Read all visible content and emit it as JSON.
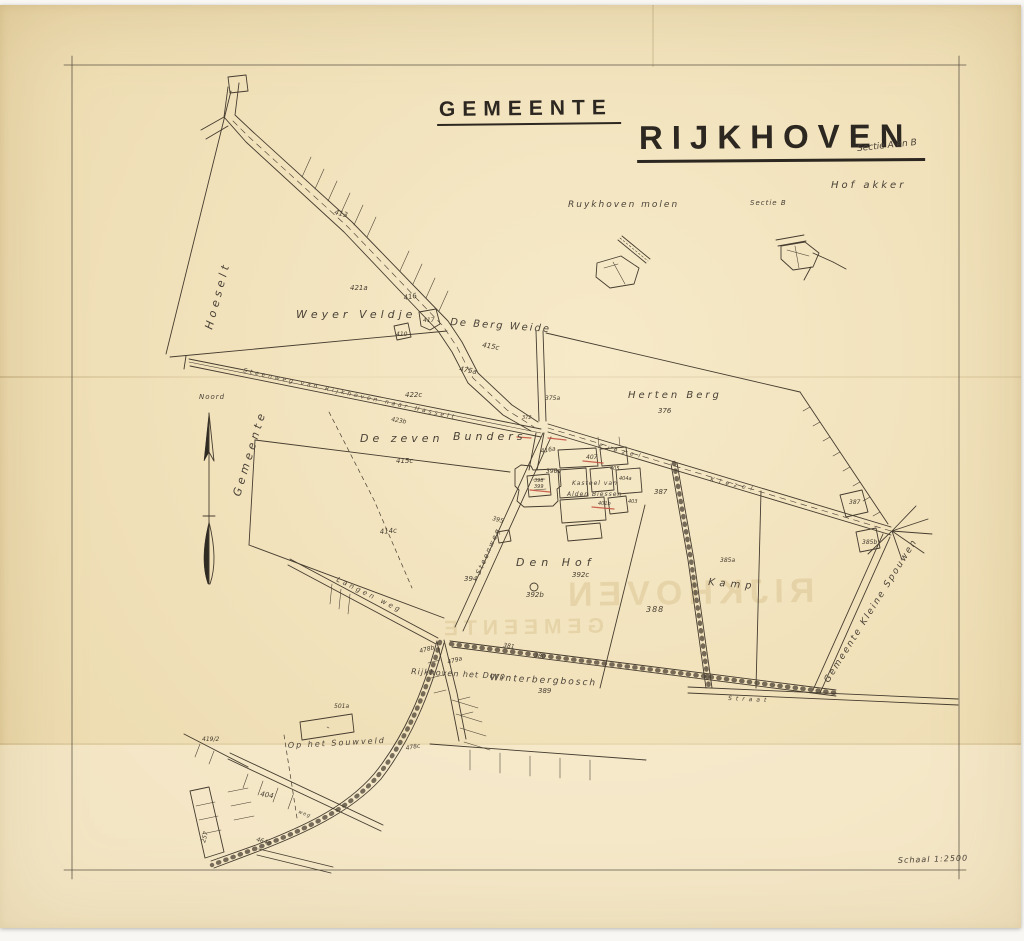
{
  "title": {
    "line1": "GEMEENTE",
    "line2": "RIJKHOVEN",
    "sectie": "Sectie A en B"
  },
  "ghost": {
    "line1": "GEMEENTE",
    "line2": "RIJKHOVEN"
  },
  "colors": {
    "paper": "#f4e4ba",
    "ink": "#453c2f",
    "red_annotation": "#c24b3c",
    "frame": "#5d5546",
    "ghost": "#c9ae74"
  },
  "map": {
    "labels": [
      {
        "id": "hoeselt",
        "text": "Hoeselt",
        "x": 212,
        "y": 330,
        "size": 11,
        "rot": -75,
        "ls": 4,
        "cls": "script"
      },
      {
        "id": "gemeente-boundary",
        "text": "Gemeente",
        "x": 240,
        "y": 497,
        "size": 11,
        "rot": -73,
        "ls": 4,
        "cls": "script"
      },
      {
        "id": "noord",
        "text": "Noord",
        "x": 199,
        "y": 399,
        "size": 7,
        "rot": 0,
        "ls": 1,
        "cls": "script"
      },
      {
        "id": "weyer-veldje",
        "text": "Weyer Veldje",
        "x": 296,
        "y": 318,
        "size": 11,
        "rot": 0,
        "ls": 4,
        "cls": "script"
      },
      {
        "id": "p421a",
        "text": "421a",
        "x": 350,
        "y": 290,
        "size": 7,
        "rot": 0,
        "ls": 0,
        "cls": "num"
      },
      {
        "id": "p413",
        "text": "413",
        "x": 334,
        "y": 214,
        "size": 7,
        "rot": 15,
        "ls": 0,
        "cls": "num"
      },
      {
        "id": "p416",
        "text": "416",
        "x": 404,
        "y": 300,
        "size": 7,
        "rot": -10,
        "ls": 0,
        "cls": "num"
      },
      {
        "id": "p417",
        "text": "417",
        "x": 423,
        "y": 322,
        "size": 6,
        "rot": 0,
        "ls": 0,
        "cls": "num"
      },
      {
        "id": "p410",
        "text": "410",
        "x": 396,
        "y": 336,
        "size": 6,
        "rot": 0,
        "ls": 0,
        "cls": "num"
      },
      {
        "id": "de-berg-weide",
        "text": "De Berg Weide",
        "x": 450,
        "y": 325,
        "size": 10,
        "rot": 4,
        "ls": 2,
        "cls": "script"
      },
      {
        "id": "p415c",
        "text": "415c",
        "x": 482,
        "y": 347,
        "size": 7,
        "rot": 10,
        "ls": 0,
        "cls": "num"
      },
      {
        "id": "p475a",
        "text": "475a",
        "x": 459,
        "y": 371,
        "size": 7,
        "rot": 10,
        "ls": 0,
        "cls": "num"
      },
      {
        "id": "p422c",
        "text": "422c",
        "x": 405,
        "y": 397,
        "size": 7,
        "rot": 0,
        "ls": 0,
        "cls": "num"
      },
      {
        "id": "steenweg-hasselt",
        "text": "Steenweg  van  Rijkhoven  naar  Hasselt",
        "x": 243,
        "y": 372,
        "size": 6,
        "rot": 12.5,
        "ls": 3,
        "cls": "road"
      },
      {
        "id": "p423b",
        "text": "423b",
        "x": 391,
        "y": 421,
        "size": 6,
        "rot": 10,
        "ls": 0,
        "cls": "num"
      },
      {
        "id": "de-zeven",
        "text": "De zeven",
        "x": 360,
        "y": 442,
        "size": 11,
        "rot": 0,
        "ls": 4,
        "cls": "script"
      },
      {
        "id": "bunders",
        "text": "Bunders",
        "x": 453,
        "y": 440,
        "size": 11,
        "rot": 0,
        "ls": 4,
        "cls": "script"
      },
      {
        "id": "p415c2",
        "text": "415c",
        "x": 396,
        "y": 463,
        "size": 7,
        "rot": 0,
        "ls": 0,
        "cls": "num"
      },
      {
        "id": "p414c",
        "text": "414c",
        "x": 380,
        "y": 534,
        "size": 7,
        "rot": -5,
        "ls": 0,
        "cls": "num"
      },
      {
        "id": "steenweg-vert",
        "text": "Steenweg",
        "x": 480,
        "y": 575,
        "size": 7,
        "rot": -66,
        "ls": 2,
        "cls": "road"
      },
      {
        "id": "herten-berg",
        "text": "Herten Berg",
        "x": 628,
        "y": 398,
        "size": 10,
        "rot": 0,
        "ls": 3,
        "cls": "script"
      },
      {
        "id": "p376",
        "text": "376",
        "x": 658,
        "y": 413,
        "size": 7,
        "rot": 0,
        "ls": 0,
        "cls": "num"
      },
      {
        "id": "kiezel1",
        "text": "Kiezel",
        "x": 598,
        "y": 448,
        "size": 6,
        "rot": 13,
        "ls": 5,
        "cls": "road"
      },
      {
        "id": "kiezel2",
        "text": "Kiezel",
        "x": 710,
        "y": 481,
        "size": 6,
        "rot": 13,
        "ls": 5,
        "cls": "road"
      },
      {
        "id": "p375a",
        "text": "375a",
        "x": 545,
        "y": 400,
        "size": 6,
        "rot": 0,
        "ls": 0,
        "cls": "num"
      },
      {
        "id": "p372",
        "text": "372",
        "x": 522,
        "y": 419,
        "size": 5,
        "rot": 0,
        "ls": 0,
        "cls": "num"
      },
      {
        "id": "p416a",
        "text": "416a",
        "x": 541,
        "y": 453,
        "size": 6,
        "rot": -10,
        "ls": 0,
        "cls": "num"
      },
      {
        "id": "p407",
        "text": "407",
        "x": 586,
        "y": 459,
        "size": 6,
        "rot": 0,
        "ls": 0,
        "cls": "num"
      },
      {
        "id": "p405",
        "text": "405",
        "x": 610,
        "y": 470,
        "size": 5,
        "rot": 0,
        "ls": 0,
        "cls": "num"
      },
      {
        "id": "p396a",
        "text": "396a",
        "x": 546,
        "y": 473,
        "size": 6,
        "rot": 0,
        "ls": 0,
        "cls": "num"
      },
      {
        "id": "p398",
        "text": "398",
        "x": 534,
        "y": 482,
        "size": 5,
        "rot": 0,
        "ls": 0,
        "cls": "num"
      },
      {
        "id": "p399",
        "text": "399",
        "x": 534,
        "y": 488,
        "size": 5,
        "rot": 0,
        "ls": 0,
        "cls": "num"
      },
      {
        "id": "kasteel-line1",
        "text": "Kasteel van",
        "x": 572,
        "y": 485,
        "size": 6,
        "rot": 0,
        "ls": 1,
        "cls": "script"
      },
      {
        "id": "kasteel-line2",
        "text": "Alden Biessen",
        "x": 567,
        "y": 496,
        "size": 6,
        "rot": 0,
        "ls": 1,
        "cls": "script"
      },
      {
        "id": "p404a",
        "text": "404a",
        "x": 619,
        "y": 480,
        "size": 5,
        "rot": 0,
        "ls": 0,
        "cls": "num"
      },
      {
        "id": "p401b",
        "text": "401b",
        "x": 598,
        "y": 505,
        "size": 5,
        "rot": 0,
        "ls": 0,
        "cls": "num"
      },
      {
        "id": "p403",
        "text": "403",
        "x": 628,
        "y": 503,
        "size": 5,
        "rot": 0,
        "ls": 0,
        "cls": "num"
      },
      {
        "id": "p387",
        "text": "387",
        "x": 654,
        "y": 494,
        "size": 7,
        "rot": 0,
        "ls": 0,
        "cls": "num"
      },
      {
        "id": "den-hof",
        "text": "Den Hof",
        "x": 516,
        "y": 566,
        "size": 11,
        "rot": 0,
        "ls": 5,
        "cls": "script"
      },
      {
        "id": "p392c",
        "text": "392c",
        "x": 572,
        "y": 577,
        "size": 7,
        "rot": 0,
        "ls": 0,
        "cls": "num"
      },
      {
        "id": "p392b",
        "text": "392b",
        "x": 526,
        "y": 597,
        "size": 7,
        "rot": 0,
        "ls": 0,
        "cls": "num"
      },
      {
        "id": "p394",
        "text": "394",
        "x": 464,
        "y": 581,
        "size": 7,
        "rot": 0,
        "ls": 0,
        "cls": "num"
      },
      {
        "id": "p395",
        "text": "395",
        "x": 492,
        "y": 520,
        "size": 6,
        "rot": 15,
        "ls": 0,
        "cls": "num"
      },
      {
        "id": "p388",
        "text": "388",
        "x": 646,
        "y": 612,
        "size": 8,
        "rot": 0,
        "ls": 1,
        "cls": "num"
      },
      {
        "id": "kamp",
        "text": "Kamp",
        "x": 708,
        "y": 585,
        "size": 10,
        "rot": 5,
        "ls": 5,
        "cls": "script"
      },
      {
        "id": "p385a",
        "text": "385a",
        "x": 720,
        "y": 562,
        "size": 6,
        "rot": 0,
        "ls": 0,
        "cls": "num"
      },
      {
        "id": "winterbergbosch",
        "text": "Winterbergbosch",
        "x": 490,
        "y": 680,
        "size": 9,
        "rot": 3,
        "ls": 2,
        "cls": "script"
      },
      {
        "id": "p389",
        "text": "389",
        "x": 538,
        "y": 693,
        "size": 7,
        "rot": 0,
        "ls": 0,
        "cls": "num"
      },
      {
        "id": "rijkhoven-dorp",
        "text": "Rijkhoven het Dorp",
        "x": 411,
        "y": 674,
        "size": 8,
        "rot": 3,
        "ls": 1,
        "cls": "script"
      },
      {
        "id": "p479a",
        "text": "479a",
        "x": 448,
        "y": 664,
        "size": 6,
        "rot": -15,
        "ls": 0,
        "cls": "num"
      },
      {
        "id": "p478b",
        "text": "478b",
        "x": 420,
        "y": 653,
        "size": 6,
        "rot": -15,
        "ls": 0,
        "cls": "num"
      },
      {
        "id": "p381",
        "text": "381",
        "x": 503,
        "y": 647,
        "size": 6,
        "rot": 8,
        "ls": 0,
        "cls": "num"
      },
      {
        "id": "p380",
        "text": "380",
        "x": 534,
        "y": 657,
        "size": 6,
        "rot": 8,
        "ls": 0,
        "cls": "num"
      },
      {
        "id": "straat",
        "text": "Straat",
        "x": 728,
        "y": 700,
        "size": 6,
        "rot": 3,
        "ls": 4,
        "cls": "road"
      },
      {
        "id": "gemeente-kleine-spouwen",
        "text": "Gemeente Kleine Spouwen",
        "x": 873,
        "y": 612,
        "size": 9,
        "rot": -58,
        "ls": 2,
        "cls": "script",
        "anchor": "middle"
      },
      {
        "id": "p387b",
        "text": "387",
        "x": 849,
        "y": 504,
        "size": 6,
        "rot": 0,
        "ls": 0,
        "cls": "num"
      },
      {
        "id": "p385b",
        "text": "385b",
        "x": 862,
        "y": 544,
        "size": 6,
        "rot": 0,
        "ls": 0,
        "cls": "num"
      },
      {
        "id": "op-het-souwveld",
        "text": "Op het Souwveld",
        "x": 288,
        "y": 748,
        "size": 8,
        "rot": -3,
        "ls": 2,
        "cls": "script"
      },
      {
        "id": "p501a",
        "text": "501a",
        "x": 334,
        "y": 708,
        "size": 6,
        "rot": 0,
        "ls": 0,
        "cls": "num"
      },
      {
        "id": "langen-weg",
        "text": "Langen weg",
        "x": 336,
        "y": 581,
        "size": 7,
        "rot": 26,
        "ls": 3,
        "cls": "road"
      },
      {
        "id": "p419-2",
        "text": "419/2",
        "x": 202,
        "y": 741,
        "size": 6,
        "rot": 0,
        "ls": 0,
        "cls": "num"
      },
      {
        "id": "p404",
        "text": "404",
        "x": 260,
        "y": 796,
        "size": 7,
        "rot": 10,
        "ls": 0,
        "cls": "num"
      },
      {
        "id": "p257",
        "text": "257",
        "x": 205,
        "y": 843,
        "size": 6,
        "rot": -75,
        "ls": 0,
        "cls": "num"
      },
      {
        "id": "p478c",
        "text": "478c",
        "x": 406,
        "y": 750,
        "size": 6,
        "rot": -10,
        "ls": 0,
        "cls": "num"
      },
      {
        "id": "p464a",
        "text": "464a",
        "x": 256,
        "y": 841,
        "size": 6,
        "rot": 15,
        "ls": 0,
        "cls": "num"
      },
      {
        "id": "weg-mark",
        "text": "weg",
        "x": 298,
        "y": 813,
        "size": 5,
        "rot": 20,
        "ls": 1,
        "cls": "road"
      },
      {
        "id": "schaal",
        "text": "Schaal 1:2500",
        "x": 898,
        "y": 863,
        "size": 8,
        "rot": -2,
        "ls": 1,
        "cls": "script"
      },
      {
        "id": "ruykhoven-molen",
        "text": "Ruykhoven  molen",
        "x": 568,
        "y": 207,
        "size": 9,
        "rot": 0,
        "ls": 2,
        "cls": "script"
      },
      {
        "id": "sectie-b",
        "text": "Sectie B",
        "x": 750,
        "y": 205,
        "size": 7,
        "rot": 0,
        "ls": 1,
        "cls": "script"
      },
      {
        "id": "hof-akker",
        "text": "Hof akker",
        "x": 831,
        "y": 188,
        "size": 10,
        "rot": 0,
        "ls": 3,
        "cls": "script"
      }
    ]
  }
}
